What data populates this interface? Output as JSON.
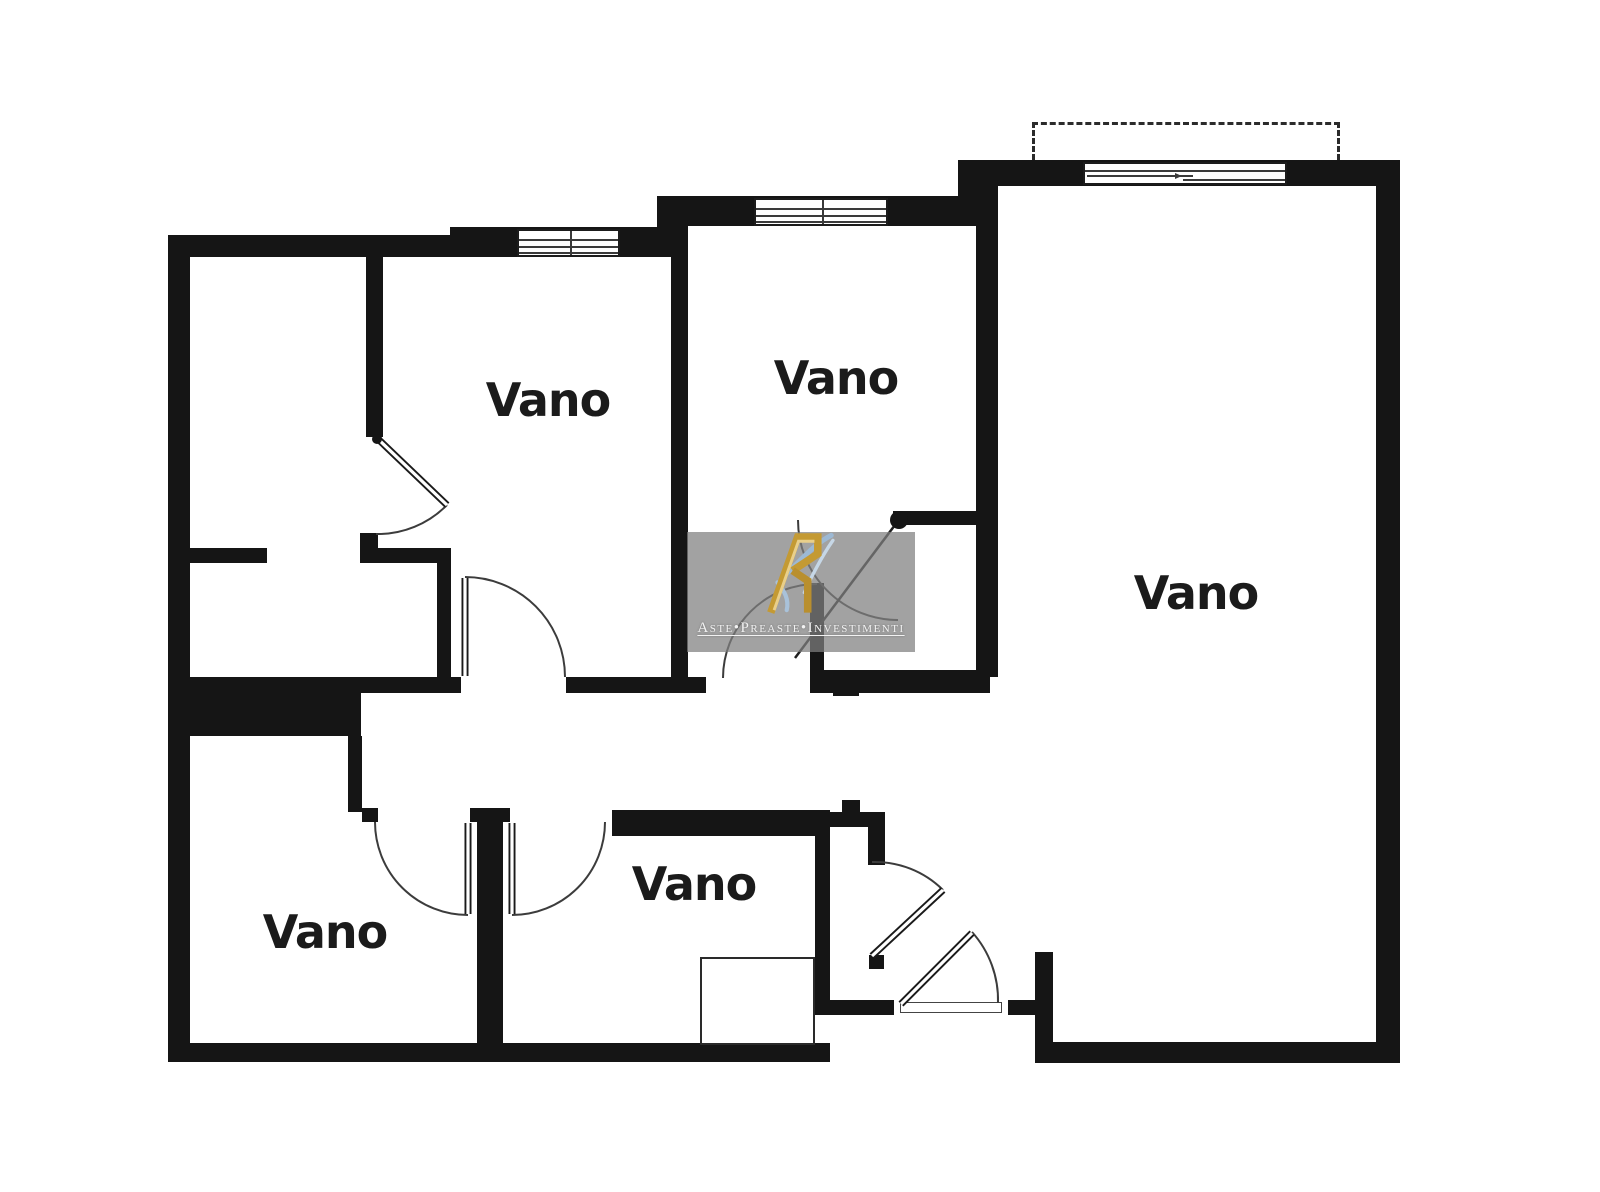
{
  "canvas": {
    "width": 1600,
    "height": 1192,
    "background": "#ffffff",
    "wall_color": "#151515"
  },
  "rooms": [
    {
      "label": "Vano",
      "cx": 548,
      "cy": 400,
      "font_size": 46
    },
    {
      "label": "Vano",
      "cx": 836,
      "cy": 378,
      "font_size": 46
    },
    {
      "label": "Vano",
      "cx": 1196,
      "cy": 593,
      "font_size": 46
    },
    {
      "label": "Vano",
      "cx": 325,
      "cy": 932,
      "font_size": 46
    },
    {
      "label": "Vano",
      "cx": 694,
      "cy": 884,
      "font_size": 46
    }
  ],
  "watermark": {
    "text": "Aste•Preaste•Investimenti",
    "box": {
      "x": 687,
      "y": 532,
      "w": 228,
      "h": 120
    },
    "background": "rgba(127,127,127,0.73)",
    "text_color": "#f2f2f2",
    "text_size": 15,
    "logo_colors": {
      "gold_dark": "#b98f2e",
      "gold_light": "#e9cf8a",
      "blue": "#9db9d4",
      "blue_light": "#c6d7e6"
    }
  },
  "floorplan": {
    "walls": [
      [
        168,
        235,
        282,
        22
      ],
      [
        450,
        227,
        208,
        30
      ],
      [
        657,
        196,
        331,
        30
      ],
      [
        657,
        196,
        31,
        61
      ],
      [
        958,
        160,
        442,
        26
      ],
      [
        958,
        160,
        30,
        66
      ],
      [
        168,
        235,
        22,
        827
      ],
      [
        1376,
        160,
        24,
        903
      ],
      [
        168,
        1043,
        662,
        19
      ],
      [
        1035,
        1042,
        365,
        21
      ],
      [
        1035,
        952,
        18,
        111
      ],
      [
        827,
        1000,
        67,
        15
      ],
      [
        1008,
        1000,
        29,
        15
      ],
      [
        671,
        226,
        17,
        467
      ],
      [
        976,
        186,
        22,
        491
      ],
      [
        366,
        257,
        17,
        180
      ],
      [
        360,
        533,
        18,
        15
      ],
      [
        190,
        548,
        77,
        15
      ],
      [
        360,
        548,
        91,
        15
      ],
      [
        437,
        563,
        14,
        114
      ],
      [
        185,
        677,
        176,
        59
      ],
      [
        361,
        677,
        100,
        16
      ],
      [
        566,
        677,
        140,
        16
      ],
      [
        810,
        670,
        180,
        23
      ],
      [
        893,
        511,
        85,
        14
      ],
      [
        348,
        736,
        14,
        76
      ],
      [
        362,
        808,
        16,
        14
      ],
      [
        470,
        808,
        40,
        14
      ],
      [
        477,
        822,
        26,
        223
      ],
      [
        612,
        810,
        218,
        26
      ],
      [
        815,
        810,
        15,
        205
      ],
      [
        830,
        812,
        55,
        15
      ],
      [
        868,
        827,
        17,
        38
      ],
      [
        842,
        800,
        18,
        12
      ],
      [
        869,
        955,
        15,
        14
      ],
      [
        833,
        684,
        26,
        12
      ],
      [
        810,
        583,
        14,
        95
      ],
      [
        700,
        957,
        115,
        8
      ]
    ],
    "windows": [
      {
        "x": 517,
        "y": 229,
        "w": 103,
        "h": 28,
        "type": "casement"
      },
      {
        "x": 754,
        "y": 198,
        "w": 134,
        "h": 28,
        "type": "casement"
      },
      {
        "x": 1083,
        "y": 162,
        "w": 204,
        "h": 23,
        "type": "sliding"
      }
    ],
    "balcony": {
      "x": 1032,
      "y": 122,
      "w": 308,
      "h": 38
    },
    "closet": {
      "x": 700,
      "y": 957,
      "w": 115,
      "h": 88
    },
    "threshold": {
      "x": 900,
      "y": 1002,
      "w": 102,
      "h": 11
    },
    "doors": {
      "arcs": [
        "M447,505 A97,97 0 0 1 376,534",
        "M465,577 A100,100 0 0 1 565,677",
        "M798,520 A100,100 0 0 0 898,620",
        "M817,584 A94,94 0 0 0 723,678",
        "M468,915 A93,93 0 0 1 375,822",
        "M512,915 A93,93 0 0 0 605,822",
        "M943,890 A97,97 0 0 0 872,862",
        "M972,932 A102,102 0 0 1 998,1003"
      ],
      "leaves": [
        [
          378,
          439,
          447,
          505
        ],
        [
          465,
          578,
          465,
          676
        ],
        [
          468,
          823,
          468,
          914
        ],
        [
          512,
          823,
          512,
          914
        ],
        [
          872,
          956,
          943,
          890
        ],
        [
          901,
          1004,
          972,
          933
        ]
      ],
      "thin_leaves": [
        [
          898,
          521,
          795,
          658
        ]
      ],
      "hinges": [
        [
          377,
          439,
          5
        ],
        [
          899,
          520,
          9
        ]
      ]
    }
  }
}
